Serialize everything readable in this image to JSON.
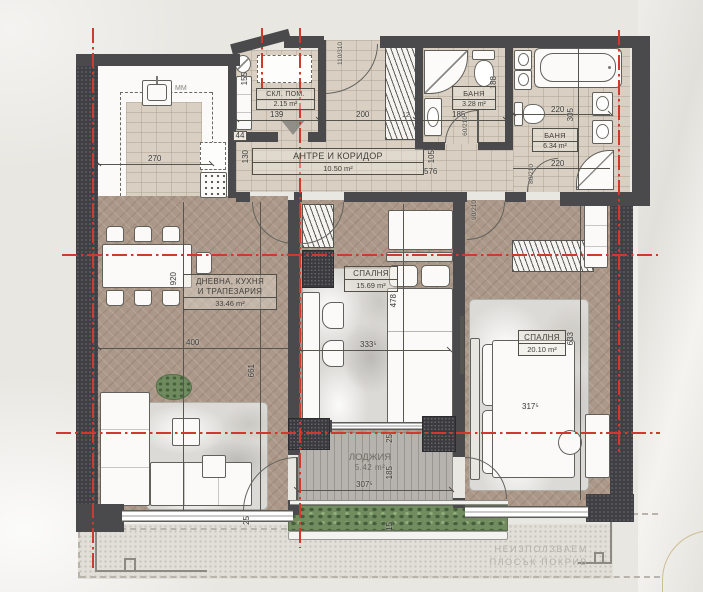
{
  "rooms": {
    "storage": {
      "name": "СКЛ. ПОМ.",
      "area": "2.15 m²"
    },
    "hall": {
      "name": "АНТРЕ И КОРИДОР",
      "area": "10.50 m²"
    },
    "bath_small": {
      "name": "БАНЯ",
      "area": "3.28 m²"
    },
    "bath_large": {
      "name": "БАНЯ",
      "area": "6.34 m²"
    },
    "living": {
      "name_line1": "ДНЕВНА, КУХНЯ",
      "name_line2": "И ТРАПЕЗАРИЯ",
      "area": "33.46 m²"
    },
    "bedroom_1": {
      "name": "СПАЛНЯ",
      "area": "15.69 m²"
    },
    "bedroom_2": {
      "name": "СПАЛНЯ",
      "area": "20.10 m²"
    },
    "loggia": {
      "name": "ЛОДЖИЯ",
      "area": "5.42 m²"
    }
  },
  "dims": {
    "kitchen_width": "270",
    "cabinet_width": "44",
    "storage_width": "139",
    "storage_depth": "155",
    "hall_width": "200",
    "wall_thickness": "12",
    "bath_small_width": "185",
    "bath_small_depth": "188",
    "bath_large_width_top": "220",
    "bath_large_depth": "305",
    "bath_large_width_bottom": "220",
    "hall_left_depth": "130",
    "hall_right_depth": "105",
    "hall_length": "576",
    "living_width": "400",
    "living_length": "661",
    "living_total_length": "920",
    "bedroom1_length": "478",
    "bedroom1_width": "333⁵",
    "bedroom2_length": "633",
    "bedroom2_width": "317⁵",
    "loggia_width": "307⁵",
    "loggia_depth": "185",
    "loggia_offset_top": "25",
    "loggia_offset_bottom": "15",
    "window_offset": "25",
    "appliance_label": "ММ"
  },
  "doors": {
    "entrance": "110/310",
    "bath_small": "60/210",
    "bath_large": "80/210",
    "bedroom_2": "90/210"
  },
  "annotations": {
    "roof_line1": "НЕИЗПОЛЗВАЕМ",
    "roof_line2": "ПЛОСЪК ПОКРИВ"
  },
  "colors": {
    "axis_red": "#d03a2e",
    "wall_dark": "#4a4a4d",
    "floor_tile": "#d9d0c3",
    "floor_wood": "#ab9889",
    "deck": "#b6b2ad",
    "planter_green": "#6f8a5e"
  }
}
